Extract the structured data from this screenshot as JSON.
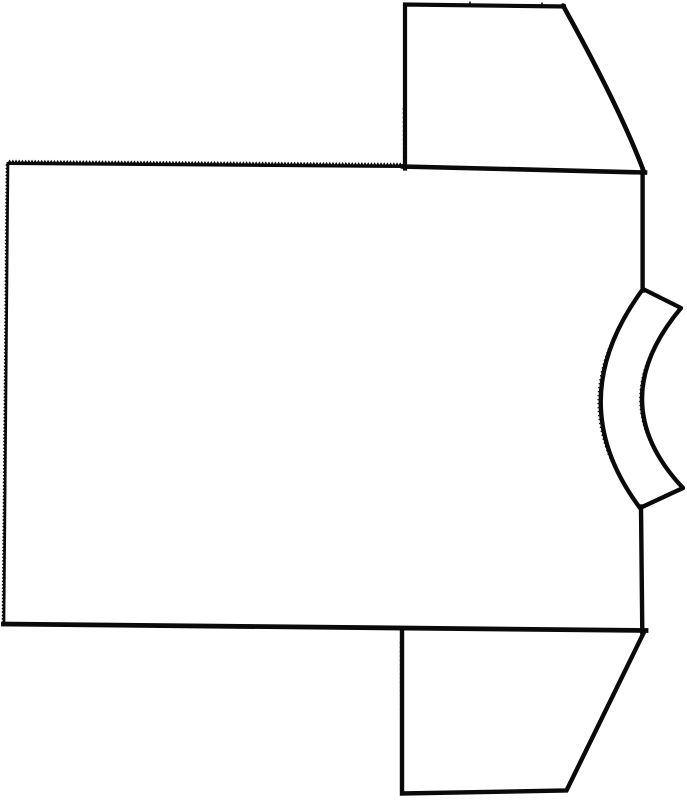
{
  "figure": {
    "kind": "garment-pattern-line-drawing",
    "subject": "T-shirt pattern piece line drawing, rotated sideways with collar facing right",
    "ink_color": "#0a0a0a",
    "paper_color": "#ffffff"
  },
  "canvas": {
    "w": 687,
    "h": 800
  },
  "drawing": {
    "elements": [
      {
        "name": "pinked-top-edge",
        "kind": "zigzag",
        "from": [
          8,
          163.5
        ],
        "to": [
          405,
          166.5
        ],
        "pitch": 3.2,
        "amp": 2.6,
        "side": 1,
        "base_width": 3,
        "tooth_width": 1.5
      },
      {
        "name": "pinked-left-edge",
        "kind": "zigzag",
        "from": [
          8,
          163.5
        ],
        "to": [
          4,
          624
        ],
        "pitch": 3.4,
        "amp": 1.8,
        "side": -1,
        "base_width": 2.6,
        "tooth_width": 1.2
      },
      {
        "name": "neckband-collar",
        "kind": "path",
        "d": "M 643,289 L 681,308 Q 602,402 683,488 L 640,508 Q 560,401 643,289 Z",
        "width": 4.3,
        "fill": "#ffffff",
        "join": "round",
        "cap": "round"
      },
      {
        "name": "neckband-outer-fuzz",
        "kind": "path",
        "d": "M 640.5,293 Q 557,402 637.5,504",
        "width": 1.1,
        "dash": "1.4,2.6"
      },
      {
        "name": "neckband-inner-fuzz",
        "kind": "path",
        "d": "M 678.5,311 Q 600,402 680.5,485",
        "width": 1.1,
        "dash": "1.4,2.6"
      },
      {
        "name": "shoulder-seam",
        "kind": "path",
        "d": "M 403,166.5 L 645,172.5",
        "width": 4.6,
        "cap": "square"
      },
      {
        "name": "body-side-right-upper",
        "kind": "path",
        "d": "M 642.6,169.5 L 642.6,290.5",
        "width": 4.4,
        "cap": "square"
      },
      {
        "name": "body-side-right-lower",
        "kind": "path",
        "d": "M 641,506.5 L 642.3,632",
        "width": 4.4,
        "cap": "square"
      },
      {
        "name": "body-hem-bottom",
        "kind": "path",
        "d": "M 646,630.5 L 3.5,624",
        "width": 4.8,
        "cap": "square"
      },
      {
        "name": "top-sleeve-outline",
        "kind": "path",
        "d": "M 405,168.5 L 405,4.5 L 564,6.5",
        "width": 4.2,
        "cap": "square",
        "join": "miter"
      },
      {
        "name": "top-sleeve-underarm",
        "kind": "path",
        "d": "M 563,5.5 Q 620,108 643.8,171.5",
        "width": 4.6,
        "cap": "round"
      },
      {
        "name": "top-sleeve-notch-1",
        "kind": "path",
        "d": "M 470,7 L 470,1.5",
        "width": 1.6,
        "cap": "butt"
      },
      {
        "name": "top-sleeve-notch-2",
        "kind": "path",
        "d": "M 542,8 L 542,2.5",
        "width": 1.6,
        "cap": "butt"
      },
      {
        "name": "top-sleeve-edge-fuzz",
        "kind": "path",
        "d": "M 403.2,108 L 403.5,164",
        "width": 1,
        "dash": "1.6,2.8"
      },
      {
        "name": "bottom-sleeve-outline",
        "kind": "path",
        "d": "M 402,629 L 402,793.5 L 566.5,790.5 L 644.3,631.5",
        "width": 4.4,
        "cap": "square",
        "join": "miter"
      },
      {
        "name": "bottom-sleeve-edge-fuzz",
        "kind": "path",
        "d": "M 400.3,642 L 400.6,778",
        "width": 1,
        "dash": "1.6,2.8"
      }
    ]
  }
}
